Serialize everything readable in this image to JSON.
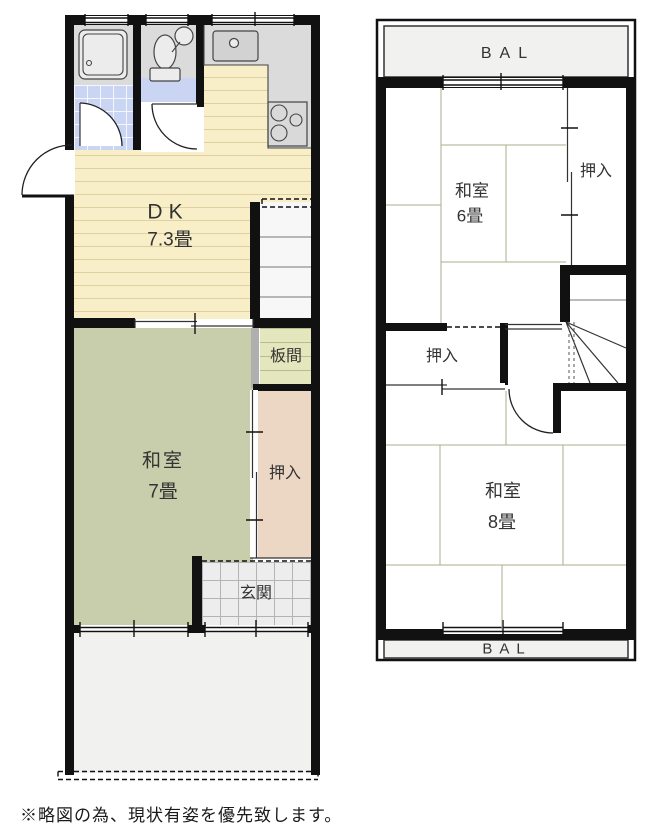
{
  "floor1": {
    "dk": {
      "label": "DK",
      "size": "7.3畳"
    },
    "washitsu7": {
      "label": "和室",
      "size": "7畳"
    },
    "itanoma": {
      "label": "板間"
    },
    "oshiire": {
      "label": "押入"
    },
    "genkan": {
      "label": "玄関"
    }
  },
  "floor2": {
    "balcony_top": {
      "label": "BAL"
    },
    "balcony_bottom": {
      "label": "BAL"
    },
    "washitsu6": {
      "label": "和室",
      "size": "6畳"
    },
    "oshiire_upper": {
      "label": "押入"
    },
    "oshiire_lower": {
      "label": "押入"
    },
    "washitsu8": {
      "label": "和室",
      "size": "8畳"
    }
  },
  "footer": {
    "note": "※略図の為、現状有姿を優先致します。"
  },
  "colors": {
    "wall": "#111111",
    "tatami": "#C8CEAB",
    "dk_floor": "#F8EFC9",
    "closet": "#ECD7C5",
    "itanoma": "#E4E7BE",
    "tile_blue": "#C9D5F2",
    "counter": "#DBDBDB",
    "genkan_tile": "#EDEDED",
    "open_area": "#F1F1EF",
    "line": "#555555"
  }
}
